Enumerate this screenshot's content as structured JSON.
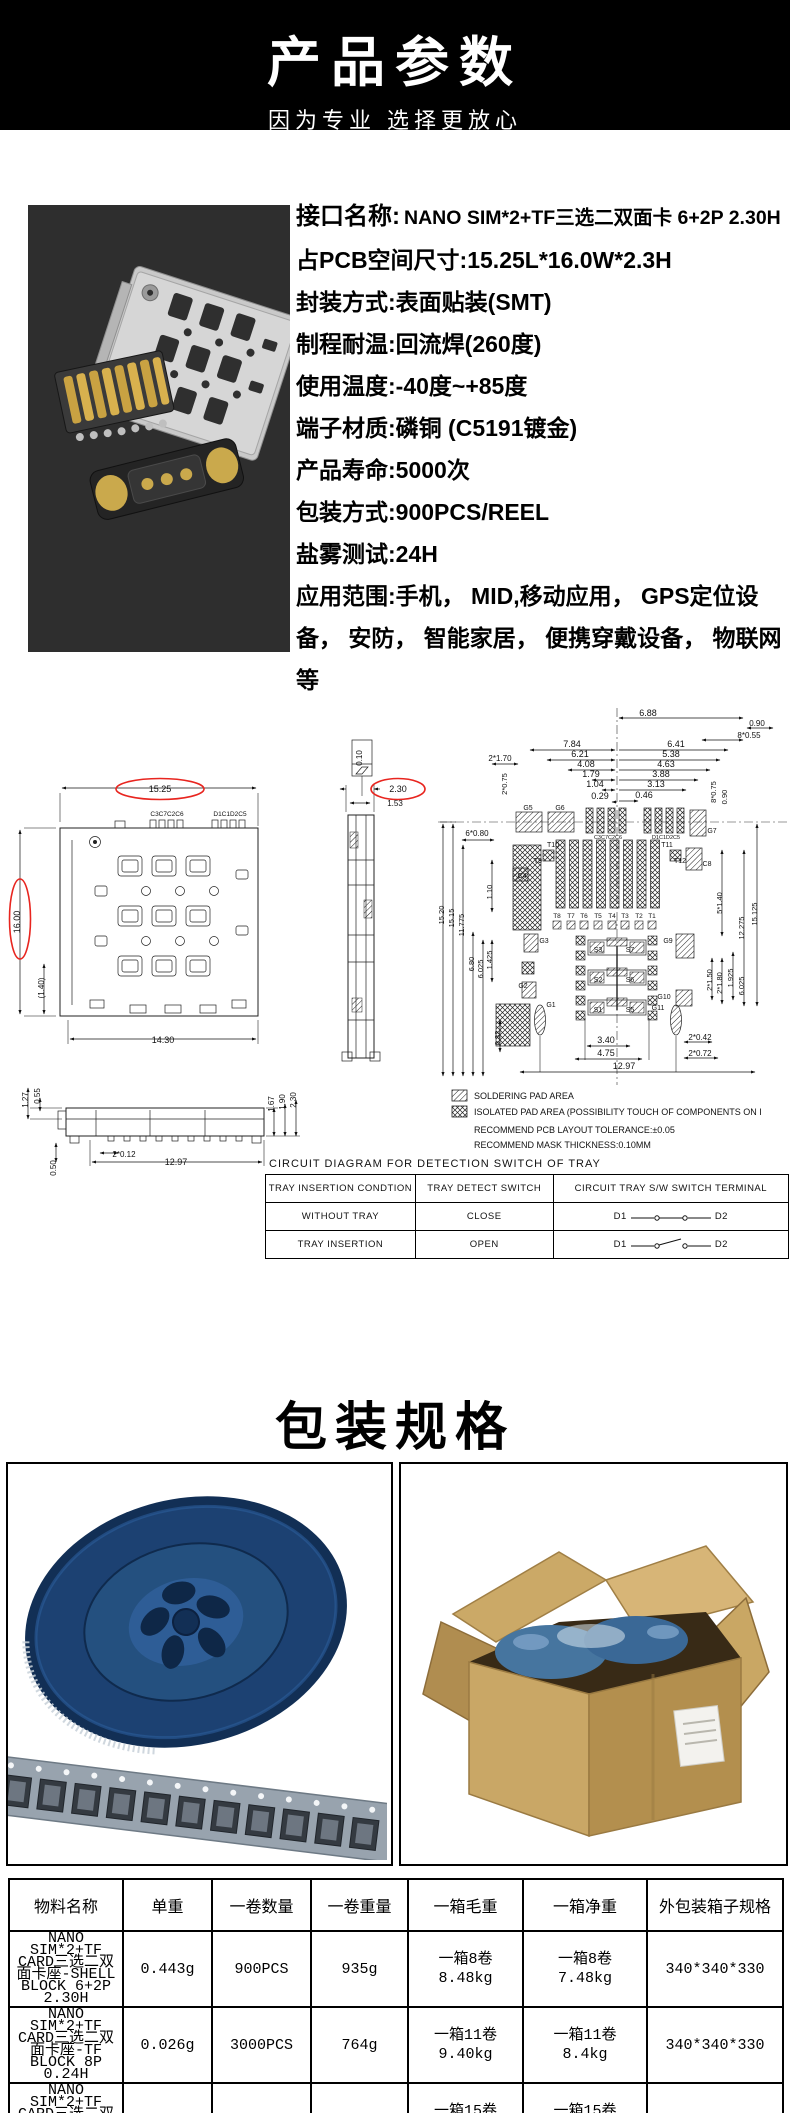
{
  "header": {
    "title": "产品参数",
    "subtitle": "因为专业 选择更放心"
  },
  "specs": {
    "interface_label": "接口名称:",
    "interface_value": "NANO SIM*2+TF三选二双面卡  6+2P 2.30H",
    "lines": [
      "占PCB空间尺寸:15.25L*16.0W*2.3H",
      "封装方式:表面贴装(SMT)",
      "制程耐温:回流焊(260度)",
      "使用温度:-40度~+85度",
      "端子材质:磷铜 (C5191镀金)",
      "产品寿命:5000次",
      "包装方式:900PCS/REEL",
      "盐雾测试:24H",
      "应用范围:手机， MID,移动应用， GPS定位设备， 安防， 智能家居， 便携穿戴设备， 物联网等"
    ]
  },
  "drawing": {
    "labels": [
      {
        "t": "15.25",
        "x": 160,
        "y": 92,
        "red": 1,
        "rx": 44
      },
      {
        "t": "C3C7C2C6",
        "x": 167,
        "y": 116,
        "fs": 6.5
      },
      {
        "t": "D1C1D2C5",
        "x": 230,
        "y": 116,
        "fs": 6.5
      },
      {
        "t": "16.00",
        "x": 20,
        "y": 222,
        "r": -90,
        "red": 1,
        "rx": 40
      },
      {
        "t": "(1.40)",
        "x": 44,
        "y": 288,
        "r": -90,
        "fs": 8
      },
      {
        "t": "14.30",
        "x": 163,
        "y": 343
      },
      {
        "t": "1.27",
        "x": 28,
        "y": 400,
        "r": -90,
        "fs": 8
      },
      {
        "t": "0.55",
        "x": 40,
        "y": 396,
        "r": -90,
        "fs": 8
      },
      {
        "t": "0.50",
        "x": 56,
        "y": 468,
        "r": -90,
        "fs": 8
      },
      {
        "t": "2*0.12",
        "x": 124,
        "y": 457,
        "fs": 8
      },
      {
        "t": "12.97",
        "x": 176,
        "y": 465
      },
      {
        "t": "1.67",
        "x": 274,
        "y": 404,
        "r": -90,
        "fs": 8
      },
      {
        "t": "1.90",
        "x": 285,
        "y": 402,
        "r": -90,
        "fs": 8
      },
      {
        "t": "2.30",
        "x": 296,
        "y": 400,
        "r": -90,
        "fs": 8
      },
      {
        "t": "0.10",
        "x": 362,
        "y": 58,
        "r": -90,
        "fs": 8
      },
      {
        "t": "2.30",
        "x": 398,
        "y": 92,
        "red": 1,
        "rx": 27
      },
      {
        "t": "1.53",
        "x": 395,
        "y": 106,
        "fs": 8
      },
      {
        "t": "6.88",
        "x": 648,
        "y": 16
      },
      {
        "t": "0.90",
        "x": 757,
        "y": 26,
        "fs": 8
      },
      {
        "t": "8*0.55",
        "x": 749,
        "y": 38,
        "fs": 8
      },
      {
        "t": "7.84",
        "x": 572,
        "y": 47
      },
      {
        "t": "6.41",
        "x": 676,
        "y": 47
      },
      {
        "t": "6.21",
        "x": 580,
        "y": 57
      },
      {
        "t": "5.38",
        "x": 671,
        "y": 57
      },
      {
        "t": "4.08",
        "x": 586,
        "y": 67
      },
      {
        "t": "4.63",
        "x": 666,
        "y": 67
      },
      {
        "t": "1.79",
        "x": 591,
        "y": 77
      },
      {
        "t": "3.88",
        "x": 661,
        "y": 77
      },
      {
        "t": "1.04",
        "x": 595,
        "y": 87
      },
      {
        "t": "3.13",
        "x": 656,
        "y": 87
      },
      {
        "t": "0.29",
        "x": 600,
        "y": 99
      },
      {
        "t": "0.46",
        "x": 644,
        "y": 98
      },
      {
        "t": "2*1.70",
        "x": 500,
        "y": 61,
        "fs": 8
      },
      {
        "t": "2*0.75",
        "x": 507,
        "y": 84,
        "r": -90,
        "fs": 7.5
      },
      {
        "t": "8*0.75",
        "x": 716,
        "y": 92,
        "r": -90,
        "fs": 7.5
      },
      {
        "t": "0.90",
        "x": 727,
        "y": 97,
        "r": -90,
        "fs": 7.5
      },
      {
        "t": "6*0.80",
        "x": 477,
        "y": 136,
        "fs": 8
      },
      {
        "t": "G5",
        "x": 528,
        "y": 110,
        "fs": 7
      },
      {
        "t": "G6",
        "x": 560,
        "y": 110,
        "fs": 7
      },
      {
        "t": "C3C7C2C6",
        "x": 608,
        "y": 139,
        "fs": 5.5
      },
      {
        "t": "D1C1D2C5",
        "x": 666,
        "y": 139,
        "fs": 5.5
      },
      {
        "t": "G7",
        "x": 712,
        "y": 133,
        "fs": 7
      },
      {
        "t": "T10",
        "x": 553,
        "y": 147,
        "fs": 7
      },
      {
        "t": "T11",
        "x": 667,
        "y": 147,
        "fs": 7
      },
      {
        "t": "T9",
        "x": 538,
        "y": 163,
        "fs": 7
      },
      {
        "t": "T12",
        "x": 680,
        "y": 163,
        "fs": 7
      },
      {
        "t": "C4",
        "x": 522,
        "y": 178,
        "fs": 7
      },
      {
        "t": "C8",
        "x": 707,
        "y": 166,
        "fs": 7
      },
      {
        "t": "T8",
        "x": 557,
        "y": 218,
        "fs": 6.5
      },
      {
        "t": "T7",
        "x": 571,
        "y": 218,
        "fs": 6.5
      },
      {
        "t": "T6",
        "x": 584,
        "y": 218,
        "fs": 6.5
      },
      {
        "t": "T5",
        "x": 598,
        "y": 218,
        "fs": 6.5
      },
      {
        "t": "T4",
        "x": 612,
        "y": 218,
        "fs": 6.5
      },
      {
        "t": "T3",
        "x": 625,
        "y": 218,
        "fs": 6.5
      },
      {
        "t": "T2",
        "x": 639,
        "y": 218,
        "fs": 6.5
      },
      {
        "t": "T1",
        "x": 652,
        "y": 218,
        "fs": 6.5
      },
      {
        "t": "S3",
        "x": 598,
        "y": 252,
        "fs": 7
      },
      {
        "t": "S7",
        "x": 630,
        "y": 252,
        "fs": 7
      },
      {
        "t": "S2",
        "x": 598,
        "y": 282,
        "fs": 7
      },
      {
        "t": "S6",
        "x": 630,
        "y": 282,
        "fs": 7
      },
      {
        "t": "S1",
        "x": 598,
        "y": 312,
        "fs": 7
      },
      {
        "t": "S5",
        "x": 630,
        "y": 312,
        "fs": 7
      },
      {
        "t": "G3",
        "x": 544,
        "y": 243,
        "fs": 7
      },
      {
        "t": "G2",
        "x": 523,
        "y": 288,
        "fs": 7
      },
      {
        "t": "G1",
        "x": 551,
        "y": 307,
        "fs": 7
      },
      {
        "t": "G9",
        "x": 668,
        "y": 243,
        "fs": 7
      },
      {
        "t": "G10",
        "x": 664,
        "y": 299,
        "fs": 7
      },
      {
        "t": "G11",
        "x": 658,
        "y": 310,
        "fs": 7
      },
      {
        "t": "15.20",
        "x": 444,
        "y": 215,
        "r": -90,
        "fs": 7.5
      },
      {
        "t": "15.15",
        "x": 454,
        "y": 218,
        "r": -90,
        "fs": 7.5
      },
      {
        "t": "11.775",
        "x": 464,
        "y": 225,
        "r": -90,
        "fs": 7.5
      },
      {
        "t": "1.10",
        "x": 492,
        "y": 192,
        "r": -90,
        "fs": 7.5
      },
      {
        "t": "6.80",
        "x": 474,
        "y": 264,
        "r": -90,
        "fs": 7.5
      },
      {
        "t": "6.025",
        "x": 483,
        "y": 269,
        "r": -90,
        "fs": 7.5
      },
      {
        "t": "1.425",
        "x": 492,
        "y": 260,
        "r": -90,
        "fs": 7.5
      },
      {
        "t": "0.32",
        "x": 500,
        "y": 338,
        "r": -90,
        "fs": 7.5
      },
      {
        "t": "5*1.40",
        "x": 722,
        "y": 203,
        "r": -90,
        "fs": 7.5
      },
      {
        "t": "12.275",
        "x": 744,
        "y": 228,
        "r": -90,
        "fs": 7.5
      },
      {
        "t": "15.125",
        "x": 757,
        "y": 214,
        "r": -90,
        "fs": 7.5
      },
      {
        "t": "2*1.50",
        "x": 712,
        "y": 280,
        "r": -90,
        "fs": 7.5
      },
      {
        "t": "2*1.80",
        "x": 722,
        "y": 283,
        "r": -90,
        "fs": 7.5
      },
      {
        "t": "1.925",
        "x": 733,
        "y": 278,
        "r": -90,
        "fs": 7.5
      },
      {
        "t": "6.025",
        "x": 744,
        "y": 286,
        "r": -90,
        "fs": 7.5
      },
      {
        "t": "3.40",
        "x": 606,
        "y": 343
      },
      {
        "t": "4.75",
        "x": 606,
        "y": 356
      },
      {
        "t": "12.97",
        "x": 624,
        "y": 369
      },
      {
        "t": "2*0.42",
        "x": 700,
        "y": 340,
        "fs": 8
      },
      {
        "t": "2*0.72",
        "x": 700,
        "y": 356,
        "fs": 8
      }
    ],
    "legend": {
      "soldering": "SOLDERING PAD AREA",
      "isolated": "ISOLATED PAD AREA (POSSIBILITY TOUCH OF COMPONENTS ON I",
      "note1": "RECOMMEND PCB LAYOUT TOLERANCE:±0.05",
      "note2": "RECOMMEND MASK THICKNESS:0.10MM"
    },
    "circuit_table": {
      "title": "CIRCUIT  DIAGRAM  FOR  DETECTION  SWITCH  OF  TRAY",
      "headers": [
        "TRAY  INSERTION  CONDTION",
        "TRAY  DETECT  SWITCH",
        "CIRCUIT  TRAY  S/W  SWITCH  TERMINAL"
      ],
      "rows": [
        {
          "condition": "WITHOUT  TRAY",
          "switch": "CLOSE",
          "t1": "D1",
          "t2": "D2",
          "state": "closed"
        },
        {
          "condition": "TRAY  INSERTION",
          "switch": "OPEN",
          "t1": "D1",
          "t2": "D2",
          "state": "open"
        }
      ]
    }
  },
  "packaging": {
    "title": "包装规格"
  },
  "materials_table": {
    "headers": [
      "物料名称",
      "单重",
      "一卷数量",
      "一卷重量",
      "一箱毛重",
      "一箱净重",
      "外包装箱子规格"
    ],
    "rows": [
      [
        "NANO SIM*2+TF CARD三选二双面卡座-SHELL BLOCK 6+2P 2.30H",
        "0.443g",
        "900PCS",
        "935g",
        "一箱8卷\n8.48kg",
        "一箱8卷\n7.48kg",
        "340*340*330"
      ],
      [
        "NANO SIM*2+TF CARD三选二双面卡座-TF BLOCK 8P 0.24H",
        "0.026g",
        "3000PCS",
        "764g",
        "一箱11卷\n9.40kg",
        "一箱11卷\n8.4kg",
        "340*340*330"
      ],
      [
        "NANO SIM*2+TF CARD三选二双面卡座-NANO SIM BLOCK 6P 0.24H",
        "0.030g",
        "4000PCS",
        "674g",
        "一箱15卷\n11.10kg",
        "一箱15卷\n10.10kg",
        "340*340*330"
      ]
    ]
  }
}
